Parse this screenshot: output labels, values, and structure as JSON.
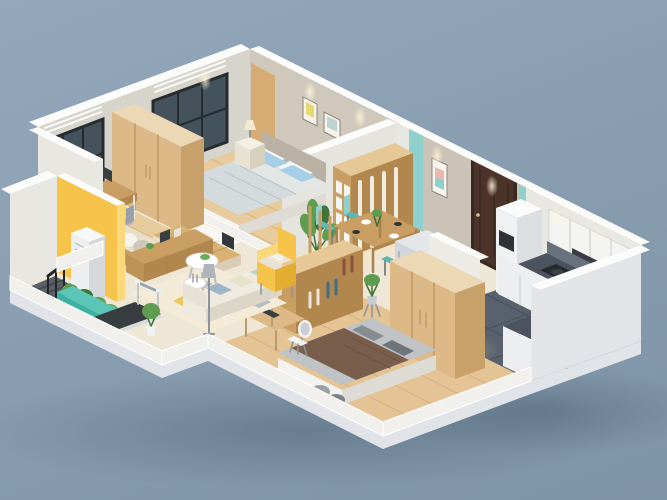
{
  "scene": {
    "label": "3D isometric cutaway rendering of an apartment floor plan, no visible text",
    "style": "photorealistic architectural render, cutaway walls, warm interior lighting",
    "rooms": [
      {
        "name": "study",
        "furniture": [
          "wood desk",
          "monitor",
          "office chair",
          "daybed with many pillows",
          "corner window",
          "ac louver vent"
        ]
      },
      {
        "name": "master-bedroom",
        "furniture": [
          "double bed with light bedding",
          "blue pillows",
          "gray headboard",
          "two wall art frames",
          "nightstands",
          "table lamp",
          "tall light-wood wardrobe",
          "picture window",
          "white fluffy rug",
          "wood plank floor"
        ]
      },
      {
        "name": "dining-area",
        "furniture": [
          "wood dining table",
          "four teal chairs",
          "place settings",
          "display bookshelf wood and white",
          "tall potted plant",
          "framed wall art",
          "teal accent stripes",
          "wood slat screen"
        ]
      },
      {
        "name": "entry",
        "furniture": [
          "dark brown entrance door",
          "wood coat ladder rack"
        ]
      },
      {
        "name": "kitchen",
        "furniture": [
          "white upper cabinets",
          "dark range hood",
          "gas cooktop with pots",
          "L-shaped counter with dark top",
          "stainless sink and faucet",
          "tall cabinet with microwave",
          "gray refrigerator",
          "plant stand",
          "dark tile floor"
        ]
      },
      {
        "name": "living-room",
        "furniture": [
          "cream fabric sofa with cushions",
          "two round white coffee tables",
          "yellow armchair",
          "low wood tv cabinet",
          "raised tatami wood platform",
          "patterned area rug",
          "floor lamp",
          "treadmill",
          "potted plants"
        ]
      },
      {
        "name": "second-bedroom",
        "furniture": [
          "double bed with brown blanket",
          "gray pillows",
          "tall wood wardrobe",
          "bookshelf room divider",
          "desk",
          "white chair",
          "wood plank floor"
        ]
      },
      {
        "name": "stair-porch",
        "furniture": [
          "stair opening",
          "black stair railing",
          "yellow accent wall",
          "floor standing ac unit",
          "teal planter box with green plants"
        ]
      }
    ]
  },
  "colors": {
    "bgTop": "#93a8ba",
    "bgBottom": "#7d93a6",
    "shadow": "#2c3e50",
    "slabSide": "#e0e4e8",
    "slabFace": "#eef0f2",
    "floorCream": "#efe7d5",
    "floorWood": "#e7cb9d",
    "floorWoodLine": "#cfa977",
    "floorWood2": "#e4c495",
    "floorKitchen": "#58616d",
    "kitchenLine": "#49525d",
    "tatami": "#d9b174",
    "tatamiLine": "#c09557",
    "wallNW": "#d7d4cb",
    "wallNE1": "#cfc8bb",
    "wallGreige": "#cbc3b5",
    "wallWhite": "#e9e7e1",
    "wallTop": "#fcfcfb",
    "partition": "#e6e4de",
    "wallSE": "#e2e4e8",
    "curb": "#f1f0ec",
    "teal": "#8ed0cb",
    "tealDark": "#5cb8b2",
    "glass": "#44525c",
    "frame": "#262b30",
    "doorWood": "#d6ac74",
    "doorBrown": "#4c3329",
    "doorFrame": "#382a21",
    "woodCab": "#c99e63",
    "woodCabShade": "#b2874e",
    "woodWard": "#ddb987",
    "woodWardShade": "#c8a06a",
    "counterTop": "#4b545e",
    "counterFace": "#eceef0",
    "backsplash": "#69727c",
    "hood": "#383d42",
    "cooktop": "#272b2f",
    "steel": "#b9c1c7",
    "fridge": "#d2d5d9",
    "fridgeShade": "#bec2c8",
    "sofa": "#eeeadf",
    "sofaShade": "#dcd6c7",
    "cushion1": "#b7d4c4",
    "cushion2": "#e7e1cd",
    "cushion3": "#9fb4c5",
    "yellow": "#f6c44a",
    "yellowSide": "#f9d87c",
    "bedWhite": "#f2f2ef",
    "bedShade": "#dddbd4",
    "bedding": "#e2e6e5",
    "blanket": "#d3dbdd",
    "pillowBlue": "#a5cfe6",
    "headboard": "#b8b1a4",
    "blanket2": "#7a5e4c",
    "mattress2": "#bfc3c6",
    "pillowGray": "#878c91",
    "white": "#ffffff",
    "rug": "#f3ebd8",
    "rugYellow": "#eec45c",
    "rugGray": "#b7bcc1",
    "rugWhite": "#faf8f2",
    "plantGreen": "#5e9c4f",
    "plantDark": "#3f7339",
    "planter": "#3eb2a2",
    "planterSide": "#2e9a8b",
    "railB": "#22262a",
    "treadDark": "#383d42",
    "treadWhite": "#edeff1",
    "grayChair": "#b5bac0",
    "lampShade": "#aeb4ba",
    "warm": "#ffdf9e"
  }
}
